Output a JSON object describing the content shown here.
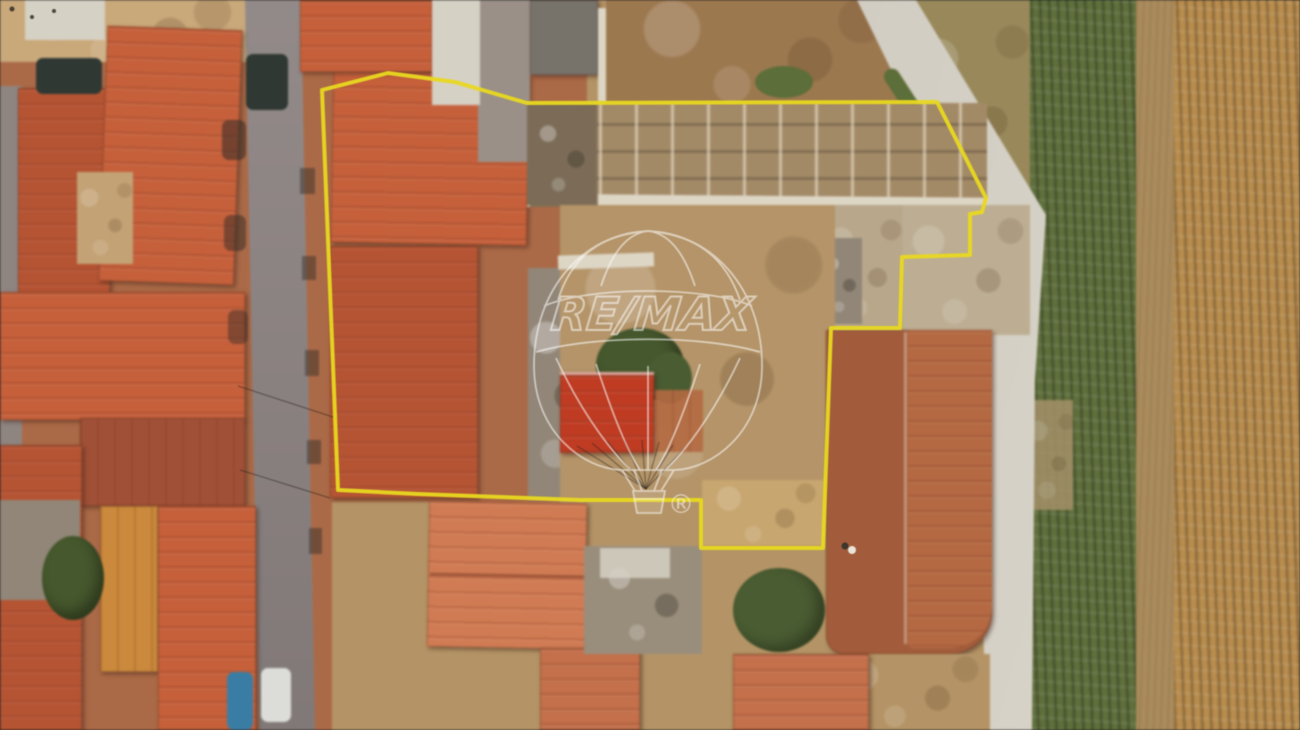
{
  "meta": {
    "kind": "aerial-drone-photograph",
    "description": "Top-down aerial photo of a village plot outlined with a yellow property boundary; RE/MAX balloon watermark in the centre"
  },
  "watermark": {
    "brand_text": "RE/MAX",
    "registered_symbol": "®",
    "color": "#ffffff",
    "opacity": "0.55"
  },
  "boundary": {
    "color": "#e8d820",
    "stroke_width": "4",
    "points": "322,90 388,73 455,82 527,103 937,102 986,198 982,212 970,214 970,255 902,257 900,328 831,328 823,548 701,548 701,500 580,500 418,494 338,490"
  },
  "palette": {
    "base_ground": "#b39468",
    "left_block_base": "#a96a49",
    "top_left_ground": "#c8a87c",
    "pale_surface": "#d6d1c5",
    "street_asphalt": "#8c8382",
    "alley_gray": "#8f8580",
    "roof_terracotta": "#c2613d",
    "roof_terracotta_mid": "#b25535",
    "roof_dark_brown": "#9e5138",
    "roof_salmon": "#cd7c55",
    "roof_salmon_deep": "#c0714d",
    "roof_ochre": "#c8893f",
    "roof_red_shed": "#bb3d25",
    "roof_large_se": "#a05c3d",
    "roof_large_se_light": "#b26a44",
    "dark_gray_roof": "#77726a",
    "gray_building": "#918678",
    "gray_court": "#9a9088",
    "rubble_gray": "#998d7c",
    "ruins_base": "#a28a68",
    "ruins_dark": "#7b6c58",
    "dirt_field_top": "#9b7851",
    "yard_dirt": "#b3946a",
    "notch_grass": "#c6a671",
    "ground_east": "#bcae94",
    "ground_east_light": "#b7a78c",
    "scrub_patch": "#97885c",
    "green_strip": "#5f6f3e",
    "tree_dark": "#46582e",
    "veg_dark": "#4a5c33",
    "hedge_green": "#5c6e3b",
    "gold_field": "#b78c50",
    "mid_path": "#a98b5e",
    "brown_gap": "#a3906a",
    "courtyard_tan": "#c2a277",
    "wall_white": "#ddd6c6",
    "car_dark": "#2f3833",
    "car_blue": "#3c7da2",
    "van_white": "#dcdcd8"
  }
}
